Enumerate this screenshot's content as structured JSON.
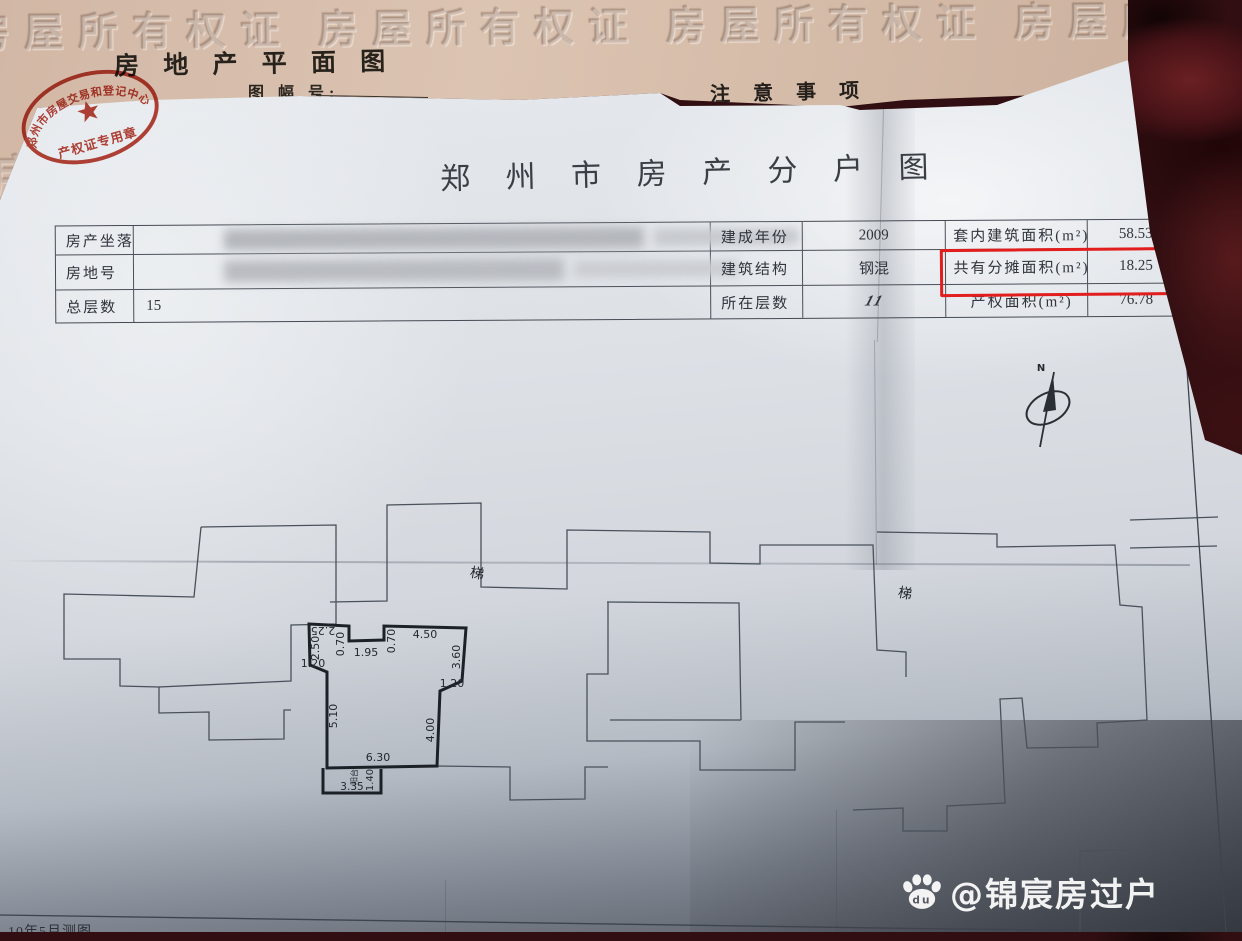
{
  "pink_sheet": {
    "title": "房 地 产 平 面 图",
    "sheet_no_label": "图 幅 号:",
    "notice_title": "注 意 事 项",
    "emboss_row_1": "房屋所有权证  房屋所有权证  房屋所有权证  房屋所有权证",
    "emboss_row_2": "房屋所有权证 房屋所有权证 房屋所有权证",
    "stamp": {
      "ring_text": "郑州市房屋交易和登记中心",
      "label": "产权证专用章"
    }
  },
  "sheet": {
    "title": "郑 州 市 房 产 分 户 图",
    "survey_note": "10年5月测图",
    "table": {
      "rows": [
        {
          "label": "房产坐落",
          "value": ""
        },
        {
          "label": "房地号",
          "value": ""
        },
        {
          "label": "总层数",
          "value": "15"
        },
        {
          "label": "建成年份",
          "value": "2009"
        },
        {
          "label": "建筑结构",
          "value": "钢混"
        },
        {
          "label": "所在层数",
          "value": "11"
        },
        {
          "label": "套内建筑面积(m²)",
          "value": "58.53"
        },
        {
          "label": "共有分摊面积(m²)",
          "value": "18.25",
          "highlighted": true
        },
        {
          "label": "产权面积(m²)",
          "value": "76.78"
        }
      ]
    },
    "compass_label": "N",
    "plan": {
      "stair_label_1": "梯",
      "stair_label_2": "梯",
      "dims": [
        {
          "v": "2.25"
        },
        {
          "v": "0.70"
        },
        {
          "v": "1.95"
        },
        {
          "v": "0.70"
        },
        {
          "v": "4.50"
        },
        {
          "v": "2.50"
        },
        {
          "v": "1.20"
        },
        {
          "v": "3.60"
        },
        {
          "v": "1.20"
        },
        {
          "v": "5.10"
        },
        {
          "v": "4.00"
        },
        {
          "v": "6.30"
        },
        {
          "v": "阳台"
        },
        {
          "v": "3.35"
        },
        {
          "v": "1.40"
        }
      ]
    }
  },
  "overlay": {
    "handle": "@锦宸房过户",
    "logo_text": "du"
  },
  "colors": {
    "highlight_box": "#e11d1d",
    "stamp_red": "#b83527",
    "pink_paper": "#d8bfad",
    "fabric": "#2e0d11"
  }
}
